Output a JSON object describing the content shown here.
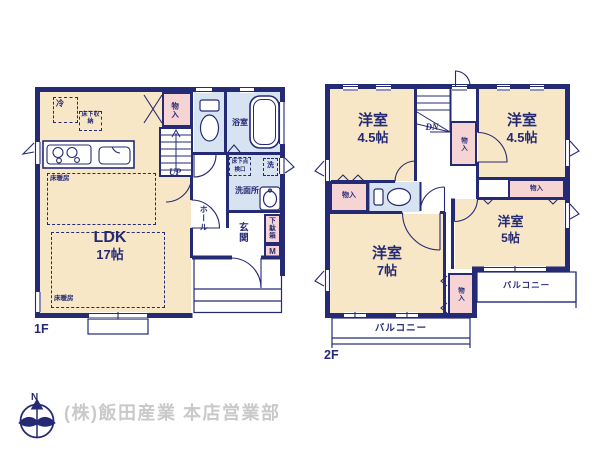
{
  "colors": {
    "wall": "#252a75",
    "room_cream": "#f8e7c6",
    "closet_pink": "#f7d4d4",
    "wet_blue": "#d7e3f1",
    "footer_gray": "#c9c9c9"
  },
  "floor1": {
    "label": "1F",
    "ldk_name": "LDK",
    "ldk_size": "17帖",
    "fridge": "冷",
    "underfloor_storage": "床下収納",
    "floor_heating_upper": "床暖房",
    "floor_heating_lower": "床暖房",
    "closet": "物入",
    "stairs": "UP",
    "bathroom": "浴室",
    "inspection_hatch": "床下点検口",
    "laundry": "洗",
    "washroom": "洗面所",
    "hall": "ホール",
    "entrance": "玄関",
    "shoe_cabinet": "下駄箱",
    "shoe_cabinet_size": "M"
  },
  "floor2": {
    "label": "2F",
    "bedroom_nw_name": "洋室",
    "bedroom_nw_size": "4.5帖",
    "bedroom_ne_name": "洋室",
    "bedroom_ne_size": "4.5帖",
    "bedroom_sw_name": "洋室",
    "bedroom_sw_size": "7帖",
    "bedroom_se_name": "洋室",
    "bedroom_se_size": "5帖",
    "stairs": "DN",
    "closet_stairs": "物入",
    "closet_west": "物入",
    "closet_east": "物入",
    "closet_center": "物入",
    "balcony_east": "バルコニー",
    "balcony_south": "バルコニー"
  },
  "footer": {
    "compass_north": "N",
    "company": "(株)飯田産業 本店営業部"
  }
}
